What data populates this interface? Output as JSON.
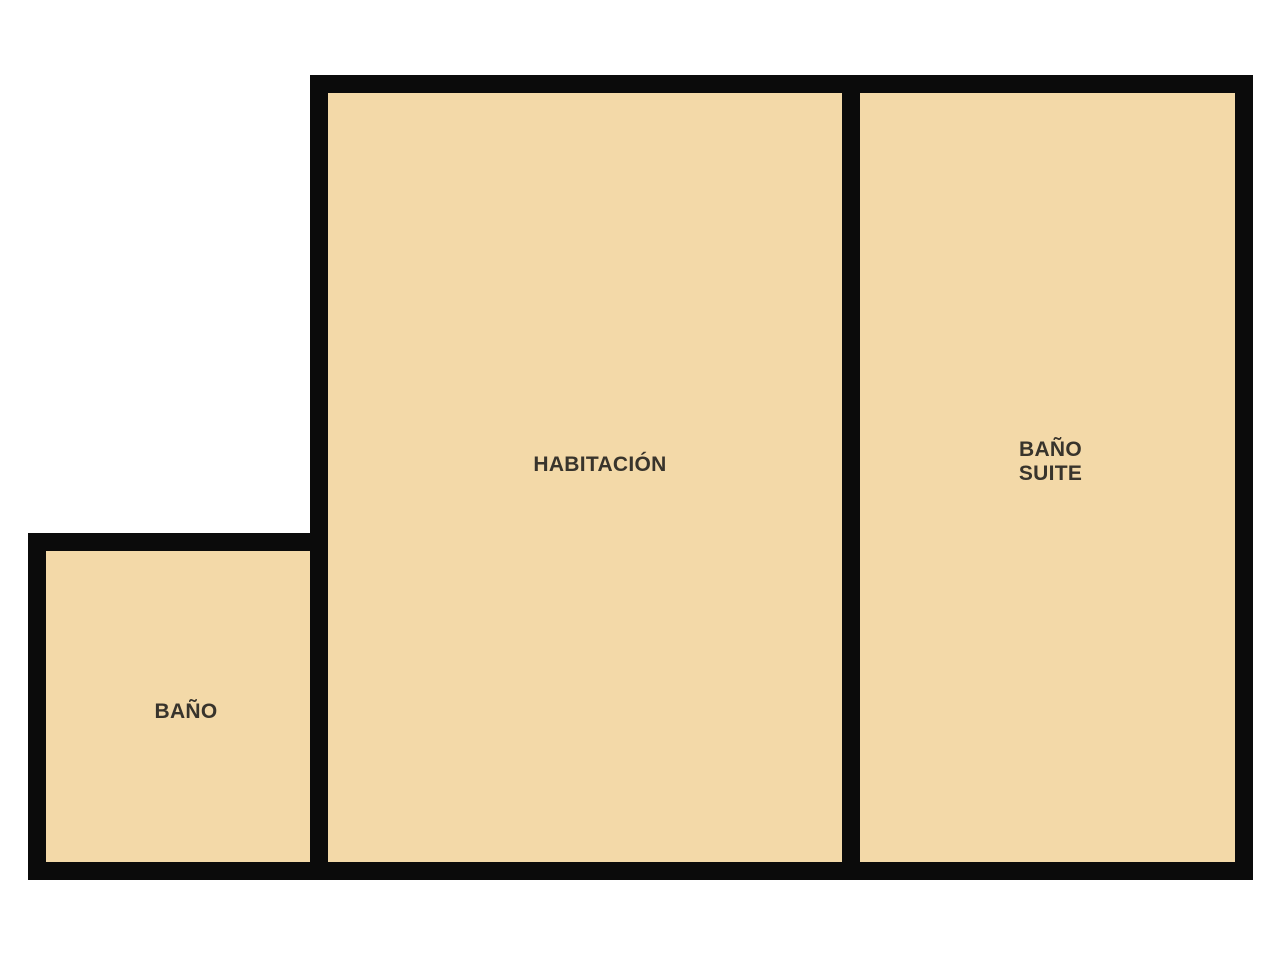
{
  "floorplan": {
    "type": "floor-plan",
    "colors": {
      "background": "#ffffff",
      "room_fill": "#f3d9a8",
      "wall": "#0b0b0b",
      "label_text": "#38342c"
    },
    "rooms": [
      {
        "id": "habitacion",
        "label": "HABITACIÓN"
      },
      {
        "id": "bano-suite",
        "label": "BAÑO\nSUITE"
      },
      {
        "id": "bano",
        "label": "BAÑO"
      }
    ]
  }
}
